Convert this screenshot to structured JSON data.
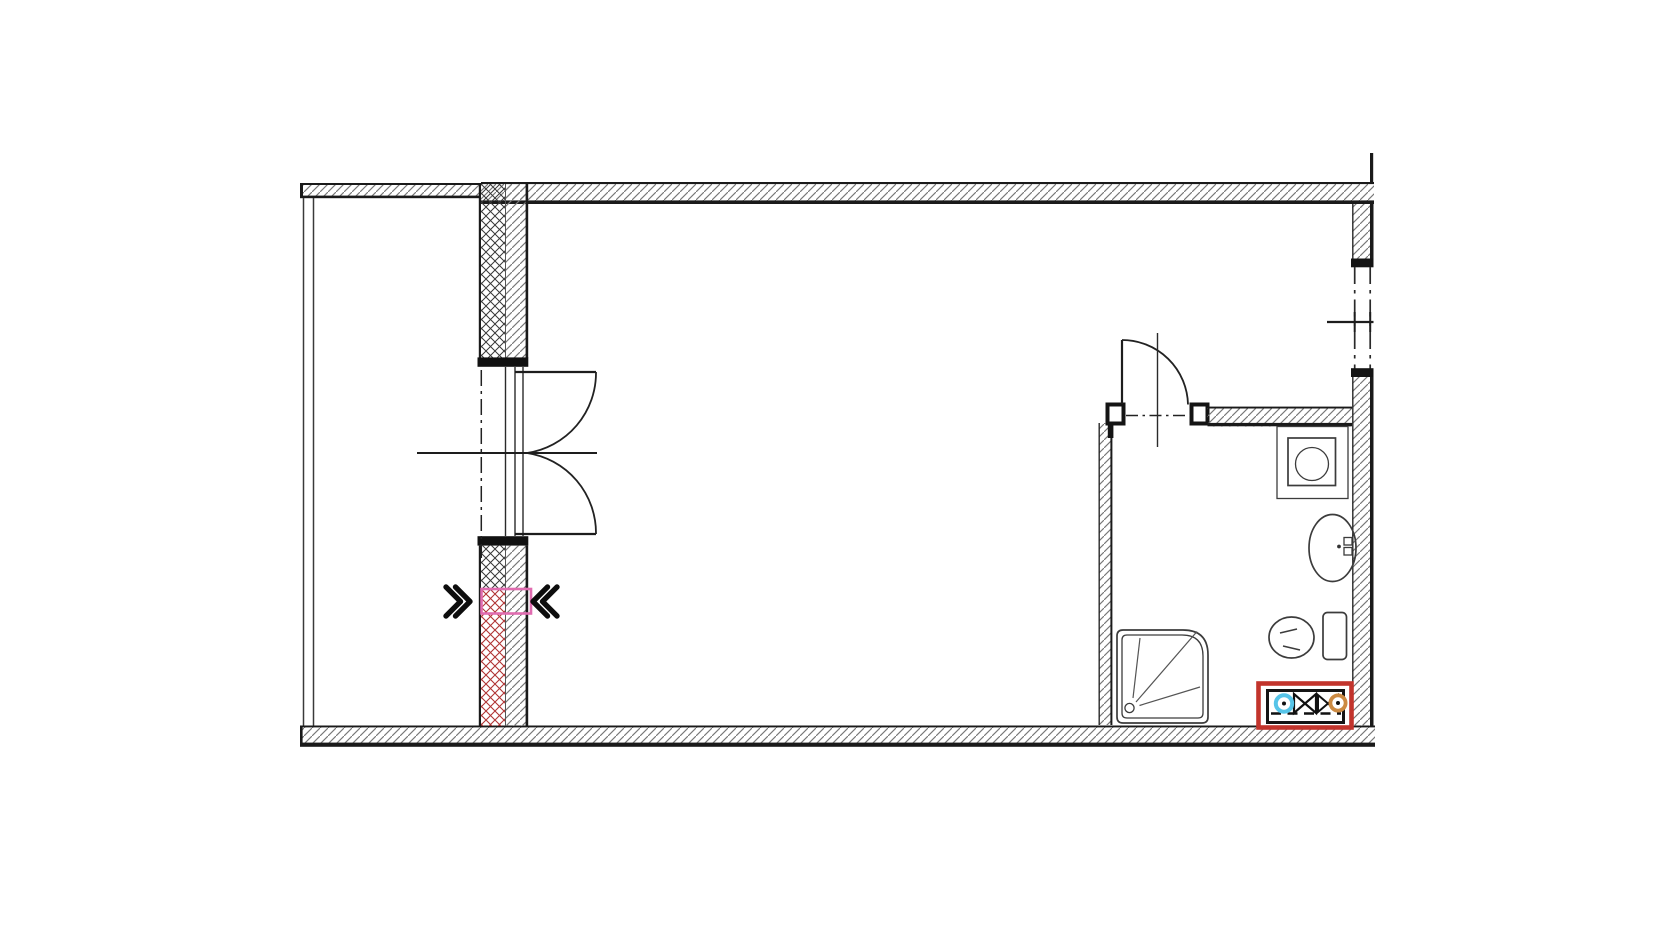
{
  "document": {
    "kind": "architectural-floor-plan",
    "background": "#ffffff",
    "width_px": 1680,
    "height_px": 945,
    "visible_text": ""
  },
  "colors": {
    "wall_line": "#1a1a1a",
    "hatch_gray": "#6e6e6e",
    "cross_hatch_black": "#383838",
    "insulation_red": "#b03434",
    "highlight_pink": "#e06cb0",
    "marker_red": "#c2342c",
    "valve_cyan": "#56c4e8",
    "valve_orange": "#cc8a42"
  },
  "symbols": {
    "balcony_double_door": "double-quarter-arc-swing",
    "bathroom_door": "quarter-arc-swing",
    "window_glass": "dash-dot-double-line",
    "wall_fill": "diagonal-hatch",
    "insulation_fill": "cross-hatch-lattice",
    "demolition_marker": "double-chevron-arrows",
    "opening_highlight": "pink-rectangle",
    "shower": "rounded-corner-tray-with-spray-lines",
    "washbasin": "vertical-oval-with-faucet",
    "toilet": "oval-bowl-with-cistern",
    "washing_machine": "square-in-square-with-circle",
    "utility_connection_unit": "red-box-with-valve-bowties"
  },
  "rooms": {
    "left_zone": "balcony-strip",
    "center_zone": "main-room-empty",
    "bottom_right_zone": "bathroom"
  }
}
